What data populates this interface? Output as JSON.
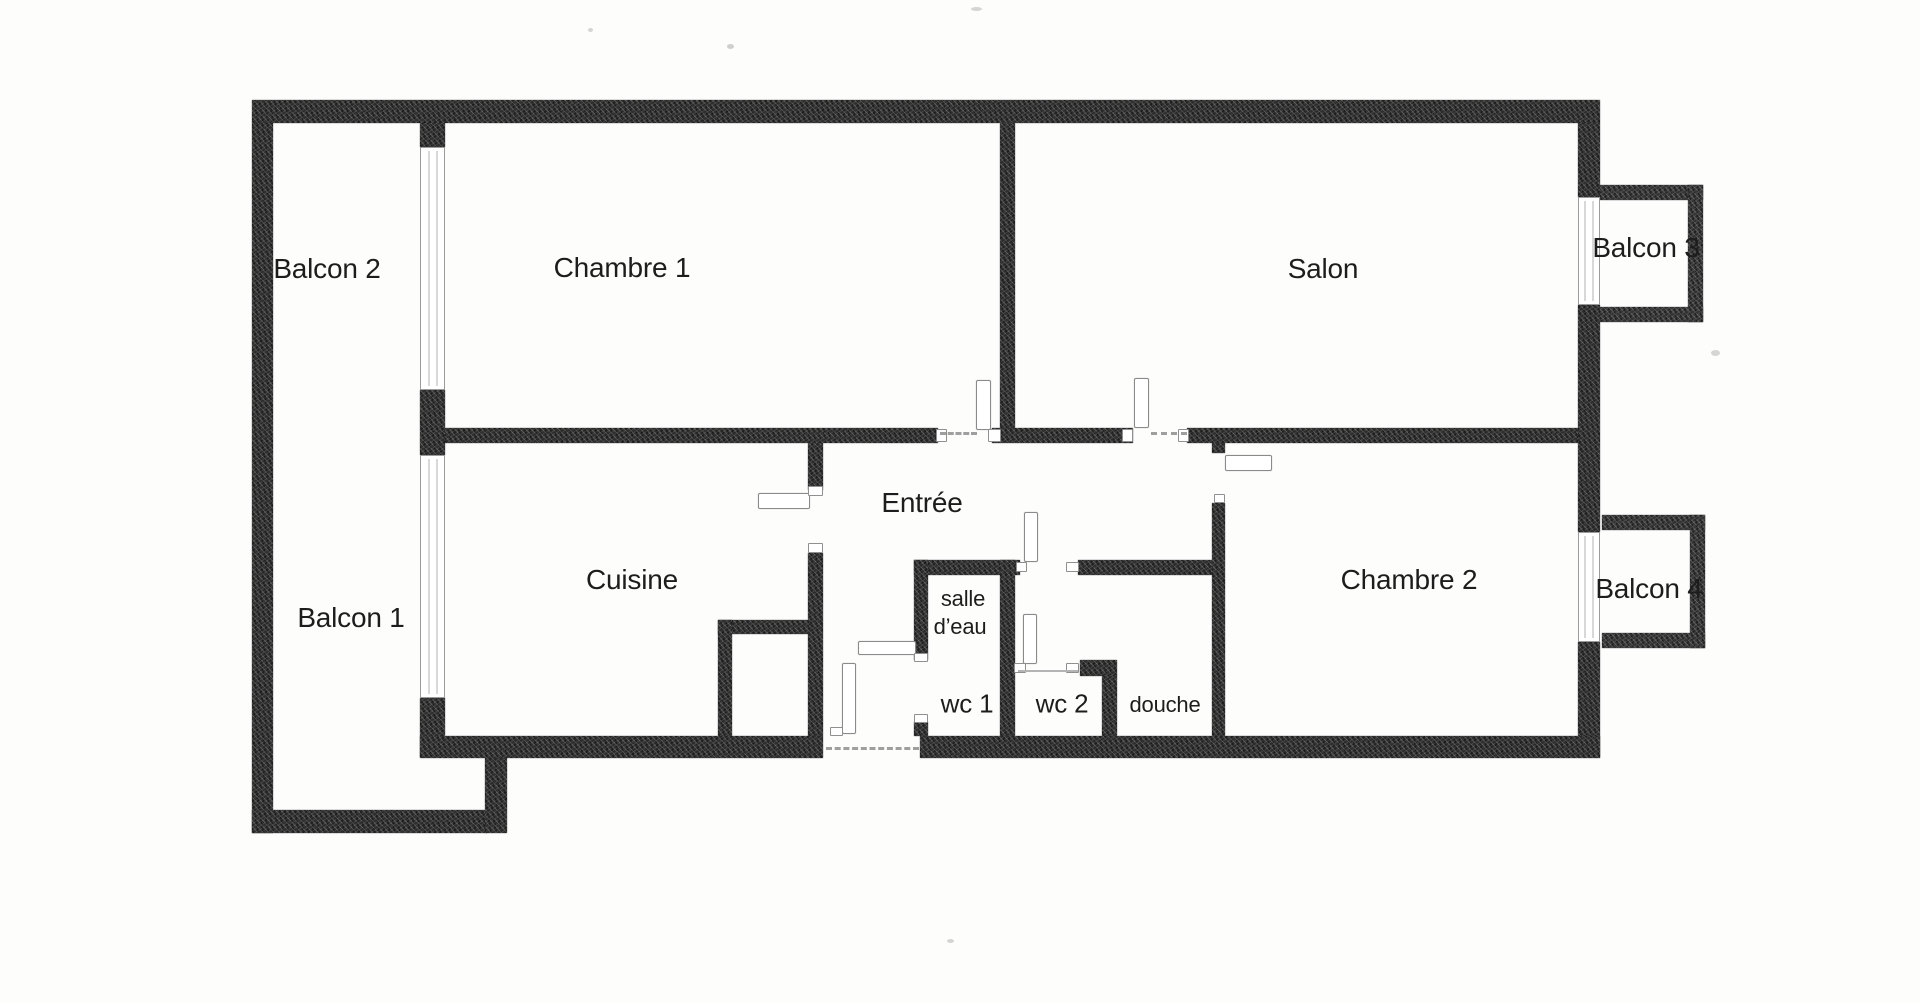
{
  "document": {
    "kind": "scanned apartment floor plan",
    "language": "fr",
    "background": "#fdfdfc"
  },
  "colors": {
    "wall": "#2e2e2e",
    "balcony_wall": "#343434",
    "window_line": "#9b9b9b",
    "door_line": "#8a8a8a",
    "threshold": "#9f9f9f",
    "label_text": "#1d1d1d"
  },
  "plan": {
    "canvas": {
      "width": 1920,
      "height": 1003
    },
    "labels": [
      {
        "id": "balcon-2",
        "text": "Balcon 2",
        "cx": 327,
        "cy": 269,
        "fs": 28
      },
      {
        "id": "chambre-1",
        "text": "Chambre 1",
        "cx": 622,
        "cy": 268,
        "fs": 28
      },
      {
        "id": "salon",
        "text": "Salon",
        "cx": 1323,
        "cy": 269,
        "fs": 28
      },
      {
        "id": "balcon-3",
        "text": "Balcon 3",
        "cx": 1646,
        "cy": 248,
        "fs": 28
      },
      {
        "id": "balcon-1",
        "text": "Balcon 1",
        "cx": 351,
        "cy": 618,
        "fs": 28
      },
      {
        "id": "cuisine",
        "text": "Cuisine",
        "cx": 632,
        "cy": 580,
        "fs": 28
      },
      {
        "id": "entree",
        "text": "Entrée",
        "cx": 922,
        "cy": 503,
        "fs": 28
      },
      {
        "id": "chambre-2",
        "text": "Chambre 2",
        "cx": 1409,
        "cy": 580,
        "fs": 28
      },
      {
        "id": "balcon-4",
        "text": "Balcon 4",
        "cx": 1649,
        "cy": 589,
        "fs": 28
      },
      {
        "id": "salle",
        "text": "salle",
        "cx": 963,
        "cy": 599,
        "fs": 22
      },
      {
        "id": "d-eau",
        "text": "d’eau",
        "cx": 960,
        "cy": 627,
        "fs": 22
      },
      {
        "id": "wc-1",
        "text": "wc 1",
        "cx": 967,
        "cy": 704,
        "fs": 26
      },
      {
        "id": "wc-2",
        "text": "wc 2",
        "cx": 1062,
        "cy": 704,
        "fs": 26
      },
      {
        "id": "douche",
        "text": "douche",
        "cx": 1165,
        "cy": 705,
        "fs": 22
      }
    ],
    "walls": [
      {
        "x": 252,
        "y": 100,
        "w": 1348,
        "h": 23,
        "t": "ext"
      },
      {
        "x": 252,
        "y": 123,
        "w": 21,
        "h": 710,
        "t": "ext"
      },
      {
        "x": 252,
        "y": 810,
        "w": 235,
        "h": 23,
        "t": "ext"
      },
      {
        "x": 485,
        "y": 757,
        "w": 22,
        "h": 76,
        "t": "ext"
      },
      {
        "x": 420,
        "y": 123,
        "w": 25,
        "h": 24,
        "t": "ext"
      },
      {
        "x": 420,
        "y": 390,
        "w": 25,
        "h": 65,
        "t": "ext"
      },
      {
        "x": 420,
        "y": 698,
        "w": 25,
        "h": 59,
        "t": "ext"
      },
      {
        "x": 1578,
        "y": 123,
        "w": 22,
        "h": 74,
        "t": "ext"
      },
      {
        "x": 1578,
        "y": 305,
        "w": 22,
        "h": 227,
        "t": "ext"
      },
      {
        "x": 1578,
        "y": 642,
        "w": 22,
        "h": 115,
        "t": "ext"
      },
      {
        "x": 420,
        "y": 736,
        "w": 403,
        "h": 22,
        "t": "ext"
      },
      {
        "x": 920,
        "y": 736,
        "w": 680,
        "h": 22,
        "t": "ext"
      },
      {
        "x": 1600,
        "y": 185,
        "w": 103,
        "h": 15,
        "t": "bal"
      },
      {
        "x": 1688,
        "y": 185,
        "w": 15,
        "h": 137,
        "t": "bal"
      },
      {
        "x": 1600,
        "y": 307,
        "w": 103,
        "h": 15,
        "t": "bal"
      },
      {
        "x": 1602,
        "y": 515,
        "w": 103,
        "h": 15,
        "t": "bal"
      },
      {
        "x": 1690,
        "y": 515,
        "w": 15,
        "h": 133,
        "t": "bal"
      },
      {
        "x": 1602,
        "y": 633,
        "w": 103,
        "h": 15,
        "t": "bal"
      },
      {
        "x": 445,
        "y": 428,
        "w": 493,
        "h": 15,
        "t": "int"
      },
      {
        "x": 992,
        "y": 428,
        "w": 141,
        "h": 15,
        "t": "int"
      },
      {
        "x": 1187,
        "y": 428,
        "w": 391,
        "h": 15,
        "t": "int"
      },
      {
        "x": 1000,
        "y": 123,
        "w": 15,
        "h": 305,
        "t": "int"
      },
      {
        "x": 1212,
        "y": 443,
        "w": 13,
        "h": 10,
        "t": "int"
      },
      {
        "x": 1212,
        "y": 503,
        "w": 13,
        "h": 233,
        "t": "int"
      },
      {
        "x": 808,
        "y": 443,
        "w": 15,
        "h": 47,
        "t": "int"
      },
      {
        "x": 808,
        "y": 553,
        "w": 15,
        "h": 183,
        "t": "int"
      },
      {
        "x": 718,
        "y": 620,
        "w": 92,
        "h": 14,
        "t": "int"
      },
      {
        "x": 718,
        "y": 620,
        "w": 14,
        "h": 116,
        "t": "int"
      },
      {
        "x": 914,
        "y": 560,
        "w": 106,
        "h": 15,
        "t": "int"
      },
      {
        "x": 1078,
        "y": 560,
        "w": 134,
        "h": 15,
        "t": "int"
      },
      {
        "x": 914,
        "y": 560,
        "w": 14,
        "h": 100,
        "t": "int"
      },
      {
        "x": 914,
        "y": 722,
        "w": 14,
        "h": 14,
        "t": "int"
      },
      {
        "x": 1000,
        "y": 560,
        "w": 15,
        "h": 176,
        "t": "int"
      },
      {
        "x": 1080,
        "y": 660,
        "w": 37,
        "h": 16,
        "t": "int"
      },
      {
        "x": 1102,
        "y": 675,
        "w": 15,
        "h": 61,
        "t": "int"
      }
    ],
    "windows": [
      {
        "x": 420,
        "y": 147,
        "w": 25,
        "h": 243,
        "o": "v"
      },
      {
        "x": 420,
        "y": 455,
        "w": 25,
        "h": 243,
        "o": "v"
      },
      {
        "x": 1578,
        "y": 197,
        "w": 22,
        "h": 108,
        "o": "v"
      },
      {
        "x": 1578,
        "y": 532,
        "w": 22,
        "h": 110,
        "o": "v"
      }
    ],
    "doors": [
      {
        "x": 976,
        "y": 380,
        "w": 15,
        "h": 50
      },
      {
        "x": 1134,
        "y": 378,
        "w": 15,
        "h": 50
      },
      {
        "x": 1225,
        "y": 455,
        "w": 47,
        "h": 16
      },
      {
        "x": 758,
        "y": 493,
        "w": 52,
        "h": 16
      },
      {
        "x": 1024,
        "y": 512,
        "w": 14,
        "h": 50
      },
      {
        "x": 1023,
        "y": 614,
        "w": 14,
        "h": 50
      },
      {
        "x": 858,
        "y": 641,
        "w": 58,
        "h": 14
      },
      {
        "x": 842,
        "y": 663,
        "w": 14,
        "h": 71
      }
    ],
    "marks": [
      {
        "x": 936,
        "y": 429,
        "w": 11,
        "h": 13
      },
      {
        "x": 988,
        "y": 429,
        "w": 13,
        "h": 13
      },
      {
        "x": 1122,
        "y": 429,
        "w": 11,
        "h": 13
      },
      {
        "x": 1178,
        "y": 429,
        "w": 11,
        "h": 13
      },
      {
        "x": 808,
        "y": 486,
        "w": 15,
        "h": 10
      },
      {
        "x": 808,
        "y": 543,
        "w": 15,
        "h": 10
      },
      {
        "x": 1214,
        "y": 494,
        "w": 11,
        "h": 9
      },
      {
        "x": 914,
        "y": 653,
        "w": 14,
        "h": 9
      },
      {
        "x": 914,
        "y": 714,
        "w": 14,
        "h": 9
      },
      {
        "x": 1016,
        "y": 562,
        "w": 11,
        "h": 10
      },
      {
        "x": 1066,
        "y": 562,
        "w": 13,
        "h": 10
      },
      {
        "x": 1014,
        "y": 663,
        "w": 12,
        "h": 10
      },
      {
        "x": 1066,
        "y": 663,
        "w": 13,
        "h": 10
      },
      {
        "x": 830,
        "y": 727,
        "w": 13,
        "h": 9
      }
    ],
    "thresholds": [
      {
        "x": 940,
        "y": 432,
        "w": 37,
        "style": "dashed"
      },
      {
        "x": 1151,
        "y": 432,
        "w": 36,
        "style": "dashed"
      },
      {
        "x": 826,
        "y": 747,
        "w": 93,
        "style": "dashed"
      },
      {
        "x": 1018,
        "y": 670,
        "w": 60,
        "style": "solid"
      }
    ],
    "specks": [
      {
        "x": 588,
        "y": 28,
        "w": 5,
        "h": 4,
        "o": 0.35
      },
      {
        "x": 727,
        "y": 44,
        "w": 7,
        "h": 5,
        "o": 0.4
      },
      {
        "x": 971,
        "y": 7,
        "w": 11,
        "h": 4,
        "o": 0.35
      },
      {
        "x": 947,
        "y": 939,
        "w": 7,
        "h": 4,
        "o": 0.35
      },
      {
        "x": 1711,
        "y": 350,
        "w": 9,
        "h": 6,
        "o": 0.35
      }
    ]
  }
}
